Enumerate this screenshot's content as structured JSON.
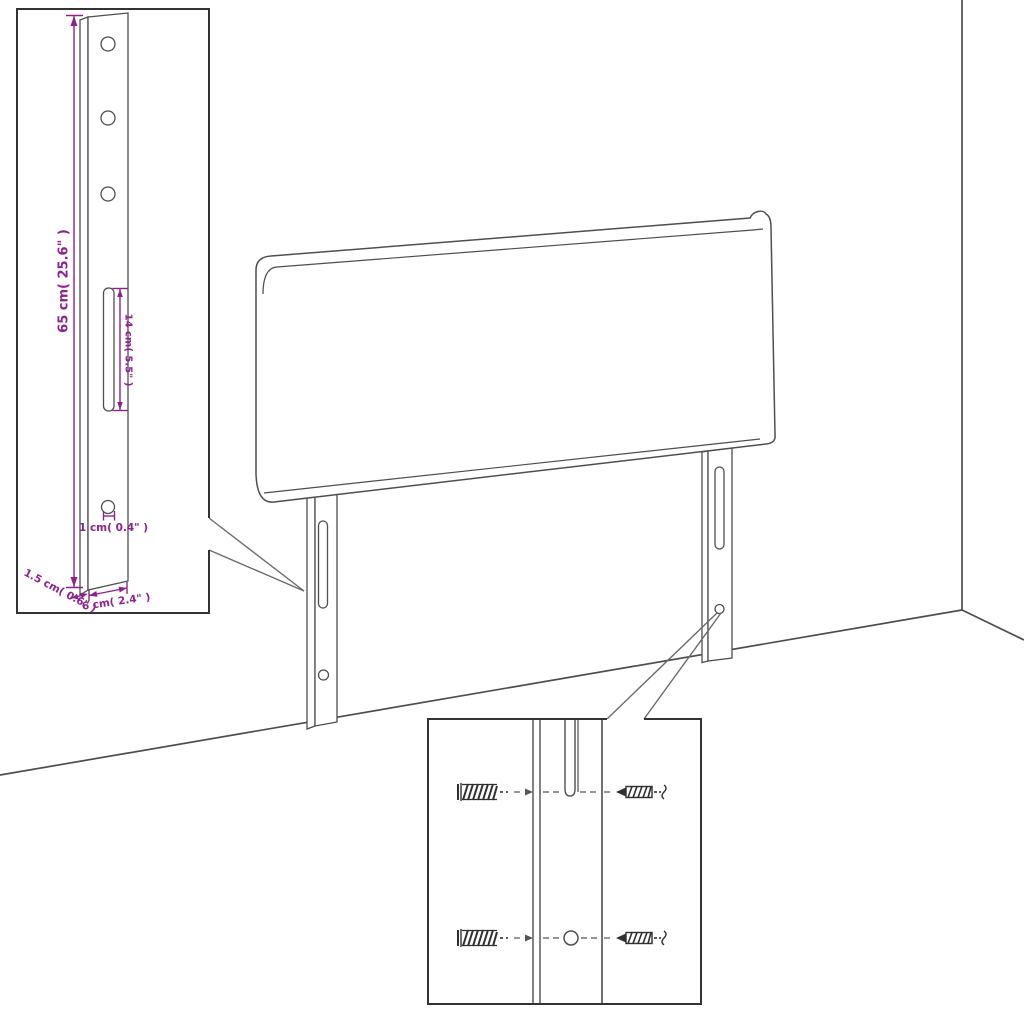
{
  "colors": {
    "line": "#4e4e4e",
    "accent": "#8e2190",
    "inset_border": "#333333",
    "background": "#ffffff",
    "hardware": "#2f2f2f",
    "connector": "#555555"
  },
  "bracket_detail_inset": {
    "labels": {
      "height": "65 cm( 25.6\" )",
      "slot_length": "14 cm( 5.5\" )",
      "hole_diameter": "1 cm( 0.4\" )",
      "side_thickness": "1.5 cm( 0.6\" )",
      "width": "6 cm( 2.4\" )"
    }
  },
  "screw_detail_inset": {
    "icons": {
      "wall_plug": "hatched-anchor-icon",
      "screw": "threaded-screw-icon"
    }
  }
}
